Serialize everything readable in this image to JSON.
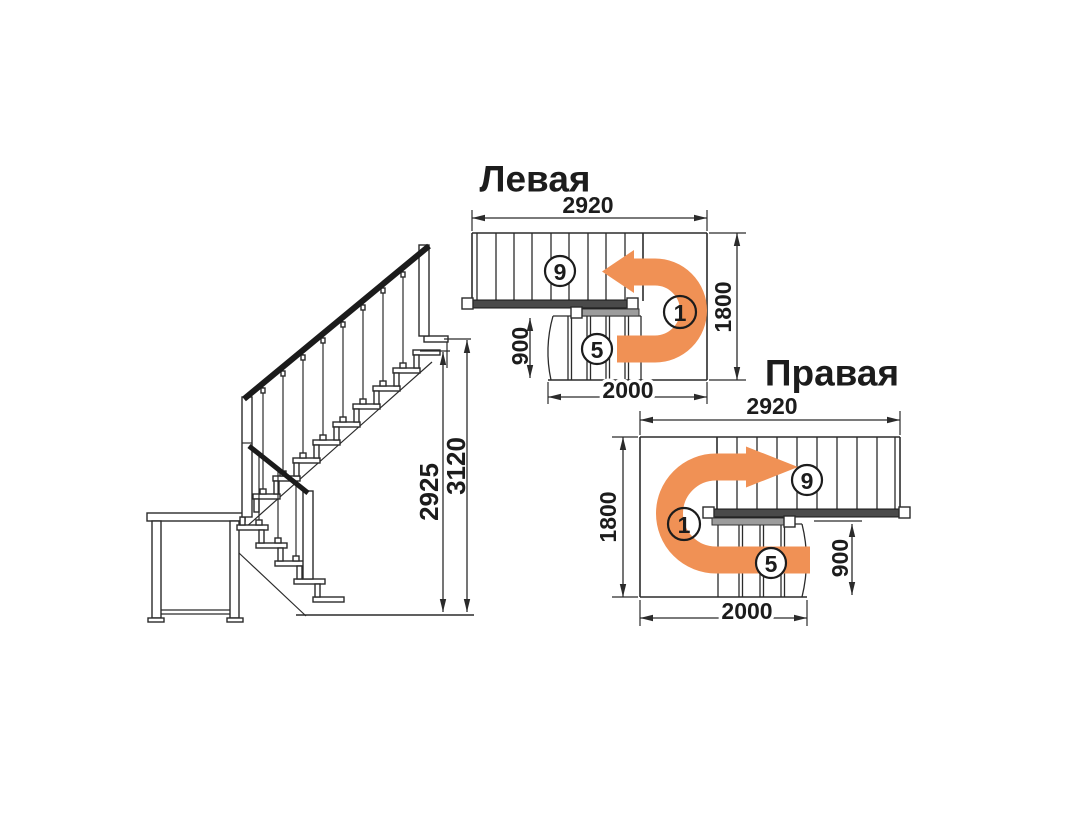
{
  "elevation": {
    "dim_inner": "2925",
    "dim_outer": "3120"
  },
  "left_plan": {
    "title": "Левая",
    "dim_top": "2920",
    "dim_right": "1800",
    "dim_flight": "900",
    "dim_bottom": "2000",
    "callout_upper": "9",
    "callout_lower": "5",
    "callout_landing": "1"
  },
  "right_plan": {
    "title": "Правая",
    "dim_top": "2920",
    "dim_left": "1800",
    "dim_flight": "900",
    "dim_bottom": "2000",
    "callout_upper": "9",
    "callout_lower": "5",
    "callout_landing": "1"
  },
  "colors": {
    "arrow": "#F09155",
    "line": "#2b2b2b",
    "dark_rail": "#4a4a4a",
    "gray_rail": "#9c9c9c",
    "text": "#1c1c1c",
    "callout_one_text": "#6b2f1c"
  }
}
